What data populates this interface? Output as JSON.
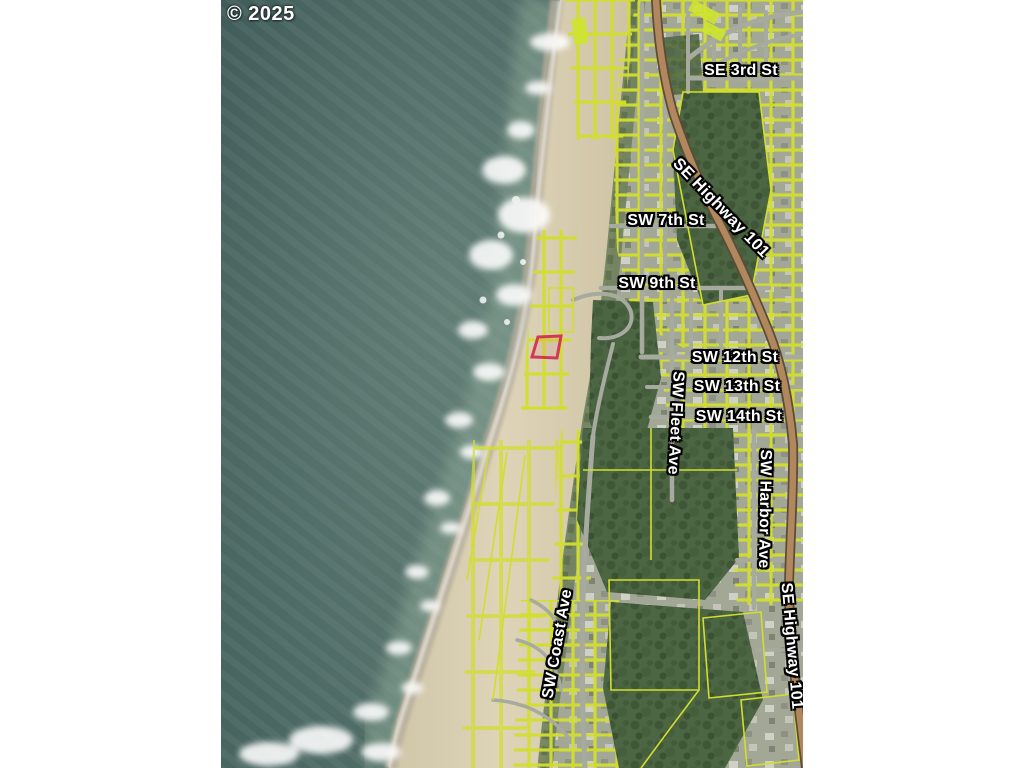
{
  "map": {
    "copyright": "© 2025",
    "street_labels": {
      "se_3rd_st": "SE 3rd St",
      "se_highway_101_upper": "SE Highway 101",
      "sw_7th_st": "SW 7th St",
      "sw_9th_st": "SW 9th St",
      "sw_12th_st": "SW 12th St",
      "sw_13th_st": "SW 13th St",
      "sw_14th_st": "SW 14th St",
      "sw_fleet_ave": "SW Fleet Ave",
      "sw_harbor_ave": "SW Harbor Ave",
      "se_highway_101_lower": "SE Highway 101",
      "sw_coast_ave": "SW Coast Ave"
    }
  },
  "colors": {
    "subject_parcel": "#d23755",
    "parcel_lines": "#d2de2e",
    "highway_fill": "#b1885e",
    "ocean": "#46615e",
    "sand": "#d8cfb2",
    "page_background": "#ffffff"
  }
}
